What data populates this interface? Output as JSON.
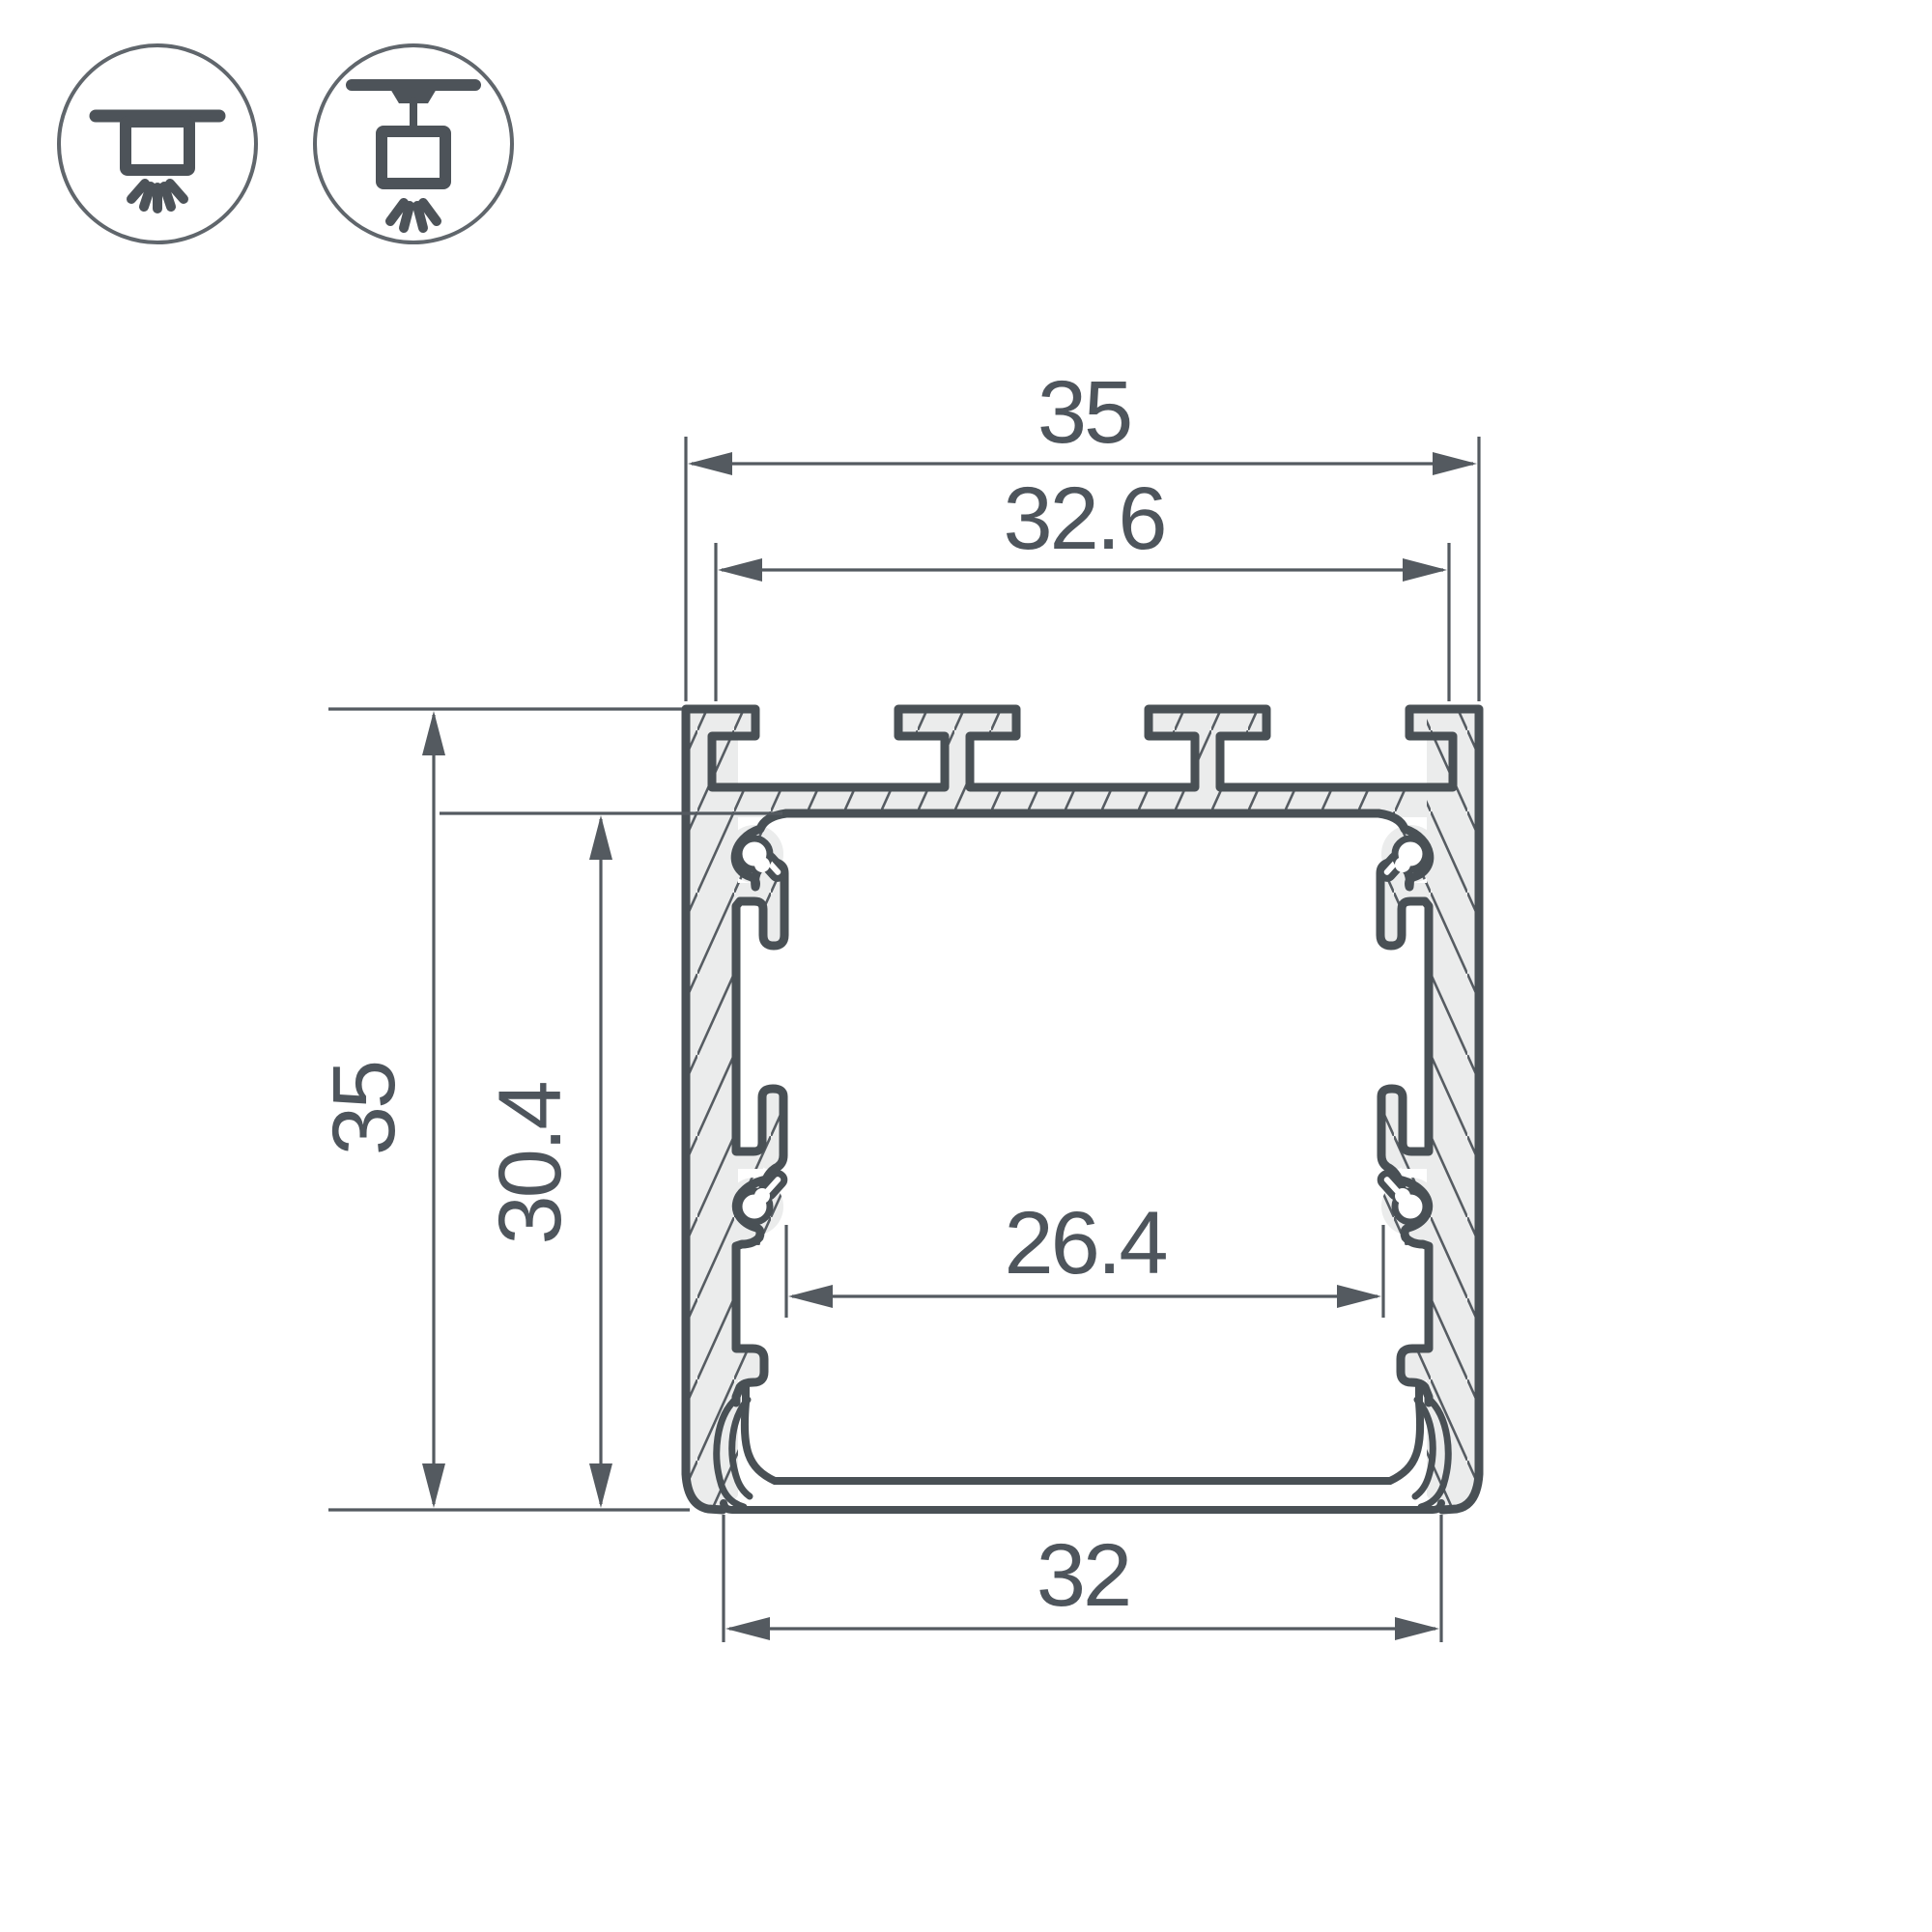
{
  "title": "LED aluminium profile cross-section drawing",
  "icons": {
    "surface_mount": "surface-mount-luminaire",
    "pendant_mount": "pendant-mount-luminaire"
  },
  "drawing": {
    "type": "technical-cross-section",
    "units": "mm",
    "dimensions": {
      "overall_width": {
        "label": "35",
        "value": 35
      },
      "slot_span_width": {
        "label": "32.6",
        "value": 32.6
      },
      "overall_height": {
        "label": "35",
        "value": 35
      },
      "inner_height": {
        "label": "30.4",
        "value": 30.4
      },
      "inner_width": {
        "label": "26.4",
        "value": 26.4
      },
      "bottom_width": {
        "label": "32",
        "value": 32
      }
    }
  },
  "colors": {
    "outline": "#495055",
    "dimension_line": "#545a60",
    "dimension_text": "#4e555c",
    "hatch_fill": "#ebecec",
    "hatch_line": "#565c62",
    "icon_stroke": "#4d5359",
    "background": "#ffffff"
  }
}
